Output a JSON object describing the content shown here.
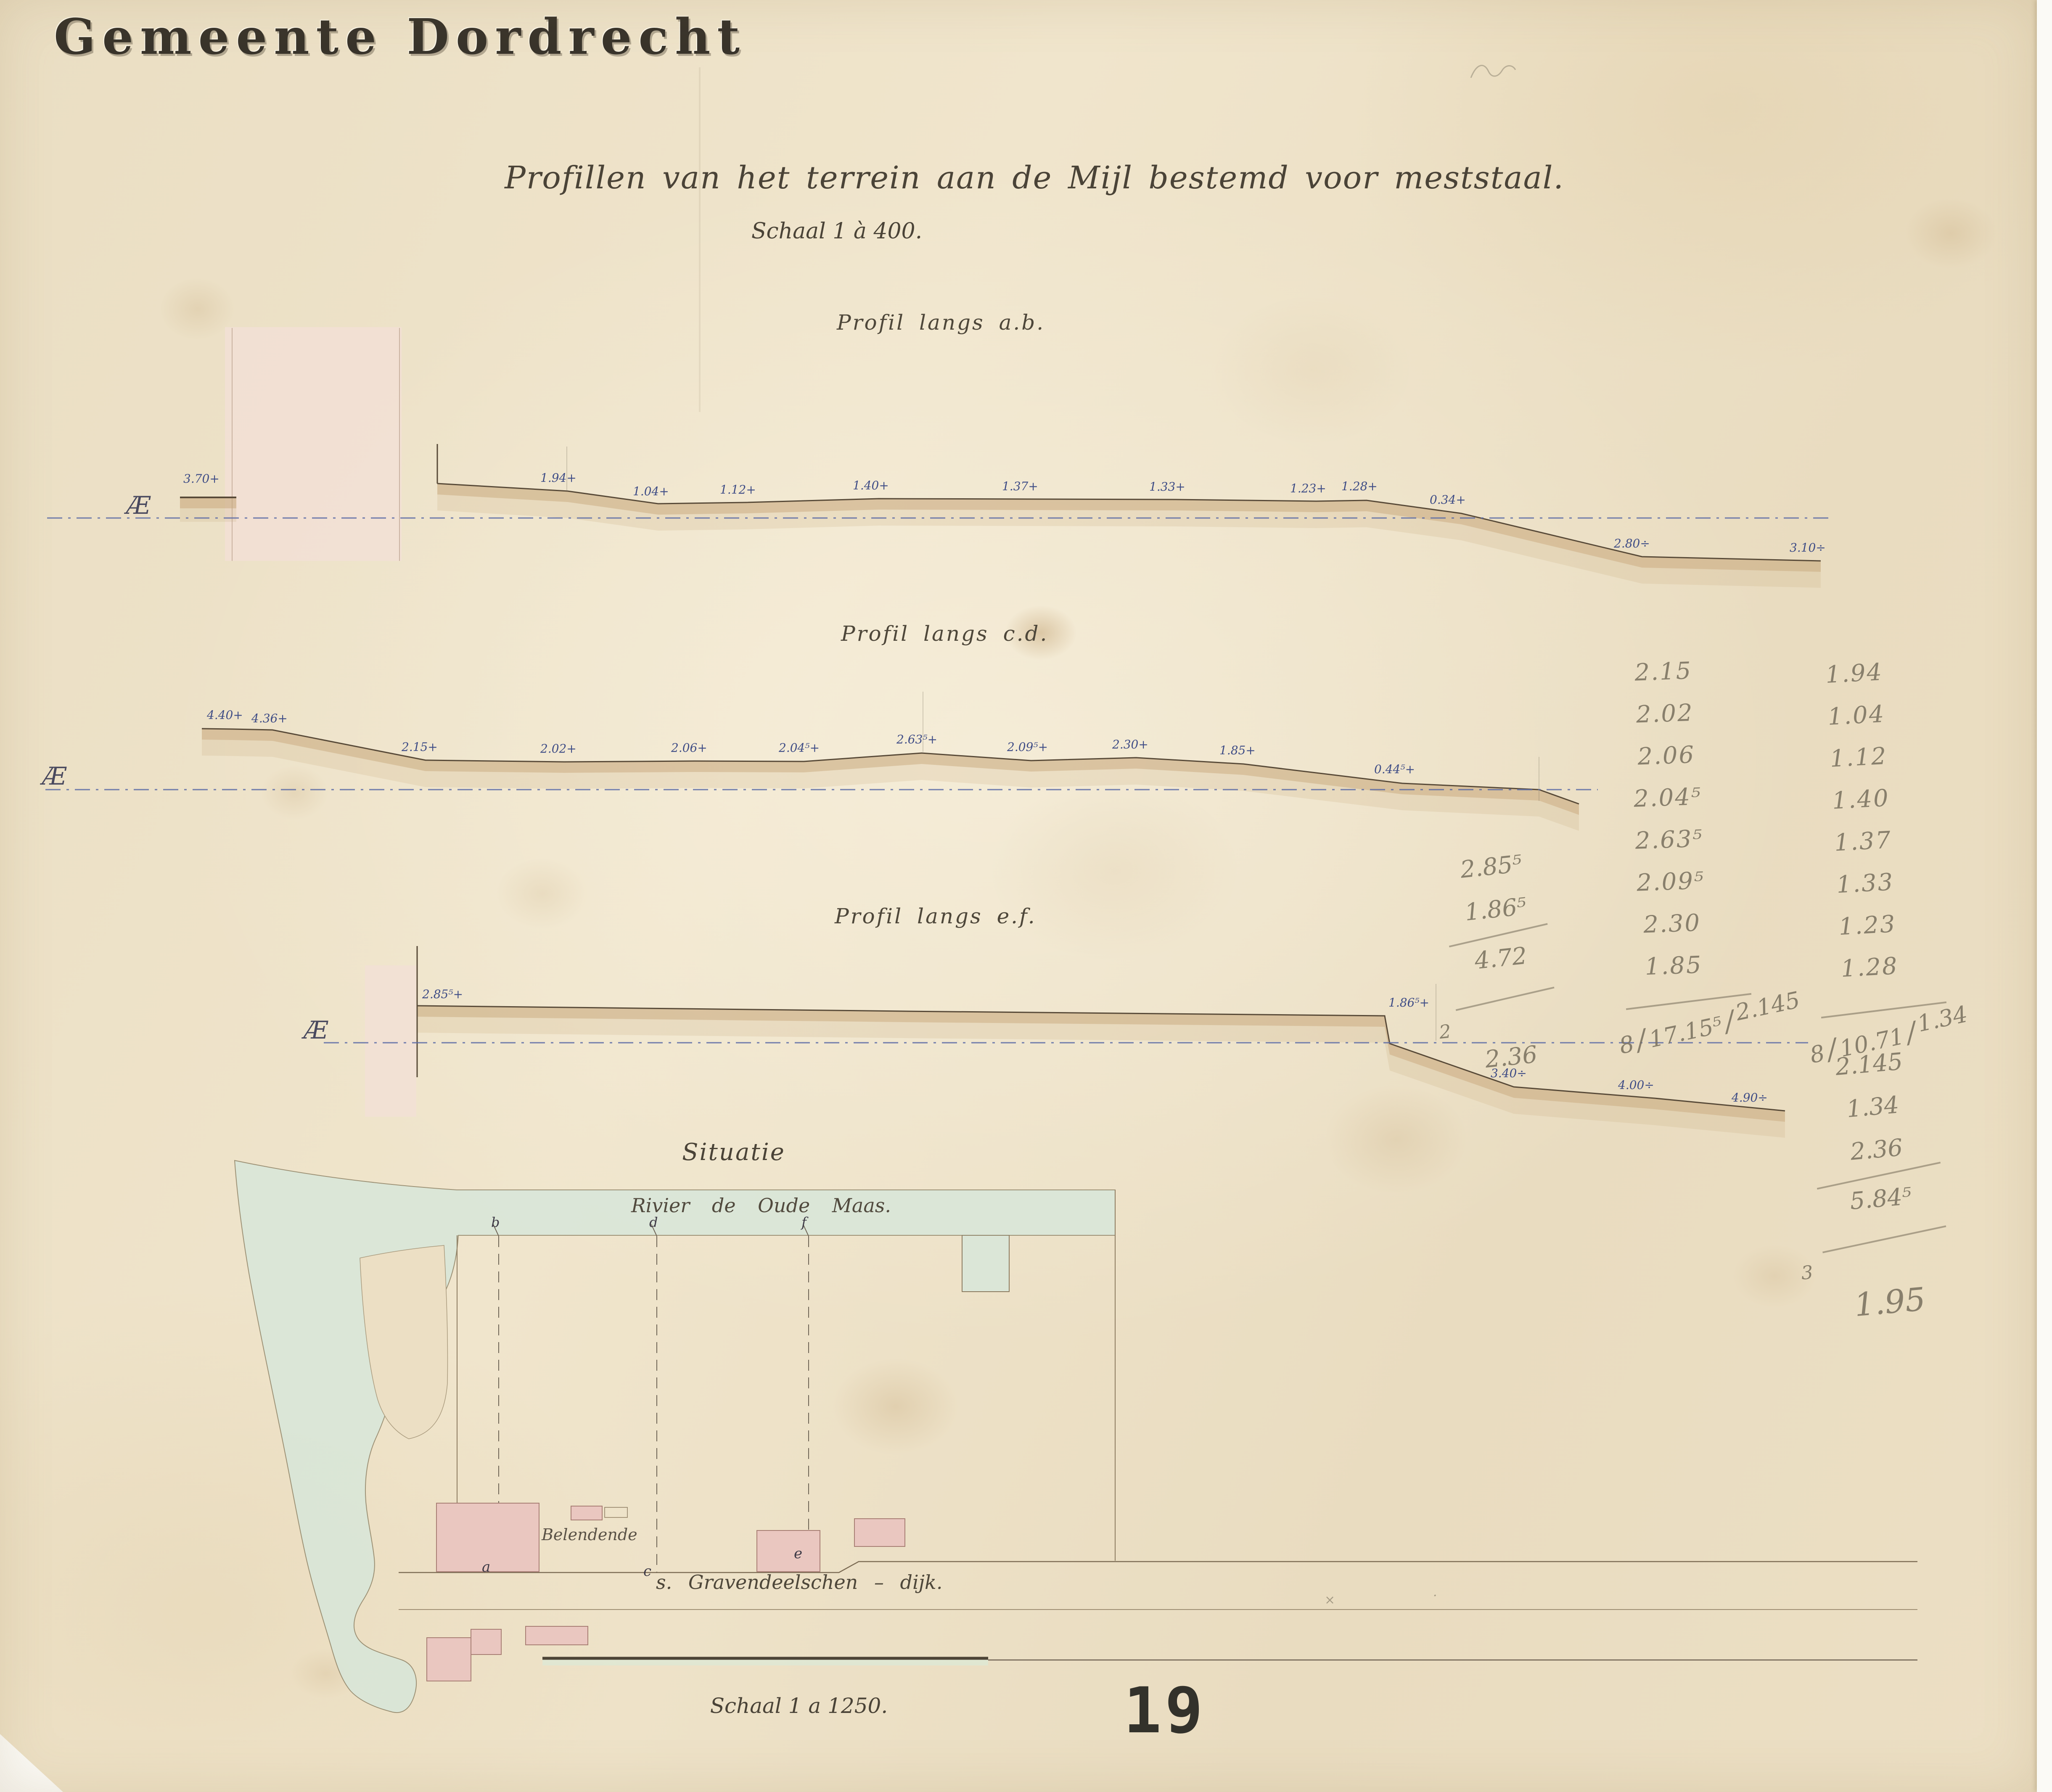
{
  "header": {
    "municipality": "Gemeente Dordrecht",
    "title": "Profillen van het terrein aan de Mijl bestemd voor meststaal.",
    "scale": "Schaal 1 à 400."
  },
  "profiles": [
    {
      "name": "Profil langs a.b.",
      "datum": "Æ",
      "block_elevation": "3.70+",
      "elevations": [
        "1.94+",
        "1.04+",
        "1.12+",
        "1.40+",
        "1.37+",
        "1.33+",
        "1.23+",
        "1.28+",
        "0.34+",
        "2.80÷",
        "3.10÷"
      ]
    },
    {
      "name": "Profil langs c.d.",
      "datum": "Æ",
      "elevations": [
        "4.40+",
        "4.36+",
        "2.15+",
        "2.02+",
        "2.06+",
        "2.04⁵+",
        "2.63⁵+",
        "2.09⁵+",
        "2.30+",
        "1.85+",
        "0.44⁵+"
      ]
    },
    {
      "name": "Profil langs e.f.",
      "datum": "Æ",
      "elevations": [
        "2.85⁵+",
        "1.86⁵+",
        "3.40÷",
        "4.00÷",
        "4.90÷"
      ]
    }
  ],
  "calculations": {
    "profile_cd_column": {
      "values": [
        "2.15",
        "2.02",
        "2.06",
        "2.04⁵",
        "2.63⁵",
        "2.09⁵",
        "2.30",
        "1.85"
      ],
      "division": {
        "divisor": "8",
        "dividend": "17.15⁵",
        "quotient": "2.145"
      }
    },
    "profile_ab_column": {
      "values": [
        "1.94",
        "1.04",
        "1.12",
        "1.40",
        "1.37",
        "1.33",
        "1.23",
        "1.28"
      ],
      "division": {
        "divisor": "8",
        "dividend": "10.71",
        "quotient": "1.34"
      }
    },
    "profile_ef_block": {
      "values": [
        "2.85⁵",
        "1.86⁵"
      ],
      "sum": "4.72",
      "divisor": "2",
      "mean": "2.36"
    },
    "mean_block": {
      "values": [
        "2.145",
        "1.34",
        "2.36"
      ],
      "sum": "5.84⁵",
      "divisor": "3",
      "mean": "1.95"
    }
  },
  "map": {
    "title": "Situatie",
    "river_label": "Rivier de Oude Maas.",
    "building_label": "Belendende",
    "dike_label": "s. Gravendeelschen – dijk.",
    "scale_label": "Schaal 1 a 1250.",
    "profile_endpoints_top": [
      "b",
      "d",
      "f"
    ],
    "profile_endpoints_bottom": [
      "a",
      "c",
      "e"
    ]
  },
  "page_number": "19",
  "colors": {
    "paper": "#ecdfc4",
    "ink_blue": "#3f4d86",
    "ink_dark": "#474033",
    "pencil": "#7d7563",
    "ground": "#584a38",
    "wash_brown": "#c9a87c",
    "wash_pink": "#f2e0d6",
    "building_pink": "#eac7c0",
    "water": "#d8e7da",
    "ap_blue": "#5b6ba6"
  }
}
